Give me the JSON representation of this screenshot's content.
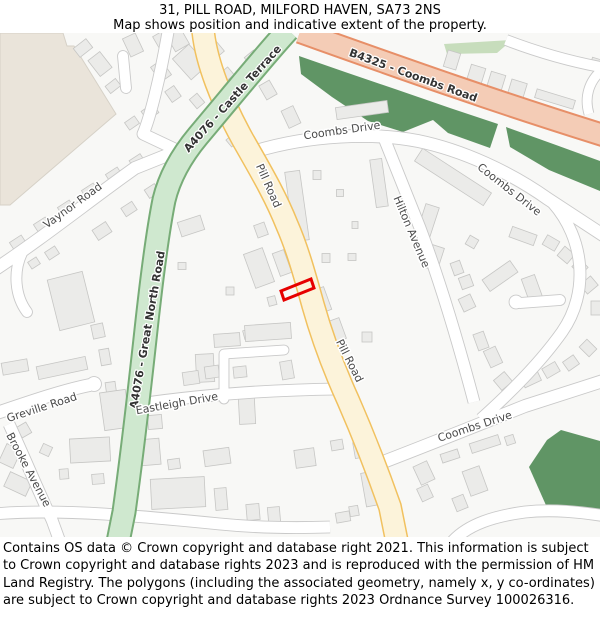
{
  "header": {
    "title": "31, PILL ROAD, MILFORD HAVEN, SA73 2NS",
    "subtitle": "Map shows position and indicative extent of the property."
  },
  "footer": {
    "text": "Contains OS data © Crown copyright and database right 2021. This information is subject to Crown copyright and database rights 2023 and is reproduced with the permission of HM Land Registry. The polygons (including the associated geometry, namely x, y co-ordinates) are subject to Crown copyright and database rights 2023 Ordnance Survey 100026316."
  },
  "map": {
    "background": "#f8f8f6",
    "colors": {
      "building_fill": "#ebebe9",
      "building_stroke": "#c6c6c4",
      "white_road_fill": "#ffffff",
      "white_road_casing": "#c9c9c9",
      "property_outline": "#e60000"
    },
    "areas": [
      {
        "name": "residential-beige-area",
        "fill": "#eae4da",
        "stroke": "#d6d1c7",
        "points": "0,33 63,33 67,46 74,46 116,114 10,205 0,205"
      },
      {
        "name": "grass-strip",
        "fill": "#c7ddbc",
        "stroke": "none",
        "points": "444,44 512,40 497,53 447,54"
      },
      {
        "name": "woodland-upper",
        "fill": "#609565",
        "stroke": "none",
        "points": "299,56 345,72 395,89 450,108 498,124 490,148 448,133 433,120 403,132 368,121 332,97 301,74"
      },
      {
        "name": "woodland-upper-right",
        "fill": "#609565",
        "stroke": "none",
        "points": "506,127 556,145 600,161 600,191 549,170 510,147"
      },
      {
        "name": "woodland-lower-right",
        "fill": "#609565",
        "stroke": "none",
        "points": "561,430 600,441 600,514 549,512 529,467 547,440"
      }
    ],
    "roads_white": [
      {
        "name": "vaynor-road",
        "d": "M -6 270 C 40 240 90 200 135 168 L 180 150",
        "w": 12
      },
      {
        "name": "vaynor-stub",
        "d": "M 22 253 C 13 272 15 296 27 312",
        "w": 10,
        "cap": "round"
      },
      {
        "name": "top-left-road",
        "d": "M 168 32 C 160 78 150 118 143 134 L 179 151",
        "w": 11
      },
      {
        "name": "top-left-stub",
        "d": "M 126 88 L 123 56",
        "w": 10,
        "cap": "round"
      },
      {
        "name": "coombs-drive-top",
        "d": "M 256 151 C 310 135 372 132 418 141 C 462 150 510 172 548 199 L 606 237",
        "w": 12
      },
      {
        "name": "hilton-avenue",
        "d": "M 384 138 L 420 228 C 435 268 455 330 474 402",
        "w": 11
      },
      {
        "name": "crescent-road",
        "d": "M 553 203 C 584 238 590 292 562 332 C 540 363 510 393 481 419",
        "w": 11
      },
      {
        "name": "crescent-spur",
        "d": "M 560 300 L 520 303",
        "w": 10,
        "cap": "round"
      },
      {
        "name": "greville-road",
        "d": "M -6 414 C 35 400 65 390 90 385",
        "w": 12
      },
      {
        "name": "brooke-avenue",
        "d": "M 9 424 C 22 452 38 490 52 520 L 60 542",
        "w": 11
      },
      {
        "name": "bottom-left-road",
        "d": "M -6 514 C 60 508 150 517 220 524 C 260 528 300 528 330 527",
        "w": 11
      },
      {
        "name": "eastleigh-drive",
        "d": "M 139 404 C 200 395 265 390 338 389",
        "w": 11
      },
      {
        "name": "service-road",
        "d": "M 224 399 L 224 354 L 284 350",
        "w": 9,
        "cap": "round"
      },
      {
        "name": "coombs-drive-bottom",
        "d": "M 378 464 C 430 444 480 424 525 406 L 606 380",
        "w": 12
      },
      {
        "name": "bottom-right-road",
        "d": "M 452 542 C 468 524 495 516 525 512 C 553 509 580 512 606 516",
        "w": 11
      },
      {
        "name": "top-right-road",
        "d": "M 506 40 C 540 53 572 62 606 68",
        "w": 10
      },
      {
        "name": "top-right-stub",
        "d": "M 602 70 C 589 81 584 97 589 114",
        "w": 9
      }
    ],
    "bulbs": [
      {
        "x": 94,
        "y": 384,
        "r": 7
      },
      {
        "x": 516,
        "y": 302,
        "r": 6.5
      }
    ],
    "roads_colored": [
      {
        "name": "pill-road",
        "fill": "#fcf3da",
        "casing": "#f1c15f",
        "w": 21,
        "cw": 24,
        "d": "M 203 30 C 206 62 222 102 243 140 C 266 180 277 200 287 225 C 298 250 306 280 313 305 C 322 337 333 367 348 400 C 362 432 377 470 390 507 L 397 542"
      },
      {
        "name": "b4325-coombs-road",
        "fill": "#f4ccb6",
        "casing": "#e78f68",
        "w": 20,
        "cw": 24,
        "d": "M 300 32 C 390 64 490 100 606 136"
      },
      {
        "name": "a4076-road",
        "fill": "#cfe8cf",
        "casing": "#77ac77",
        "w": 21,
        "cw": 25,
        "d": "M 288 30 C 265 55 235 92 198 136 C 183 154 170 175 164 200 C 158 230 152 275 146 330 C 140 385 132 455 124 512 L 118 542"
      }
    ],
    "buildings": [
      [
        83,
        48,
        16,
        11,
        -38
      ],
      [
        100,
        64,
        15,
        20,
        -38
      ],
      [
        113,
        86,
        13,
        9,
        -38
      ],
      [
        133,
        45,
        14,
        20,
        -25
      ],
      [
        162,
        40,
        13,
        15,
        -30
      ],
      [
        178,
        40,
        16,
        18,
        -30
      ],
      [
        161,
        71,
        13,
        18,
        -35
      ],
      [
        173,
        94,
        11,
        13,
        -35
      ],
      [
        150,
        112,
        14,
        11,
        -35
      ],
      [
        132,
        123,
        12,
        9,
        -35
      ],
      [
        190,
        62,
        22,
        28,
        -42
      ],
      [
        214,
        48,
        12,
        18,
        -40
      ],
      [
        227,
        74,
        10,
        10,
        -40
      ],
      [
        197,
        101,
        10,
        12,
        -40
      ],
      [
        207,
        121,
        13,
        17,
        -40
      ],
      [
        233,
        140,
        11,
        9,
        -40
      ],
      [
        254,
        60,
        12,
        16,
        -40
      ],
      [
        268,
        90,
        12,
        16,
        -30
      ],
      [
        291,
        117,
        13,
        19,
        -25
      ],
      [
        18,
        243,
        14,
        10,
        -33
      ],
      [
        42,
        225,
        14,
        10,
        -33
      ],
      [
        66,
        208,
        14,
        10,
        -33
      ],
      [
        90,
        191,
        14,
        10,
        -33
      ],
      [
        114,
        175,
        14,
        10,
        -33
      ],
      [
        137,
        161,
        13,
        9,
        -33
      ],
      [
        34,
        263,
        10,
        8,
        -33
      ],
      [
        52,
        253,
        12,
        9,
        -33
      ],
      [
        102,
        231,
        16,
        12,
        -33
      ],
      [
        129,
        209,
        13,
        10,
        -33
      ],
      [
        152,
        191,
        12,
        10,
        -33
      ],
      [
        170,
        174,
        11,
        9,
        -33
      ],
      [
        71,
        301,
        36,
        52,
        -14
      ],
      [
        98,
        331,
        12,
        14,
        -12
      ],
      [
        105,
        357,
        10,
        16,
        -10
      ],
      [
        111,
        389,
        10,
        14,
        -8
      ],
      [
        15,
        367,
        26,
        12,
        -10
      ],
      [
        62,
        368,
        50,
        13,
        -12
      ],
      [
        24,
        430,
        11,
        12,
        -30
      ],
      [
        10,
        456,
        16,
        20,
        25
      ],
      [
        18,
        484,
        24,
        16,
        25
      ],
      [
        46,
        450,
        10,
        10,
        25
      ],
      [
        191,
        226,
        24,
        15,
        -18
      ],
      [
        182,
        266,
        8,
        7,
        0
      ],
      [
        230,
        291,
        8,
        8,
        0
      ],
      [
        261,
        230,
        11,
        13,
        -20
      ],
      [
        259,
        268,
        20,
        36,
        -20
      ],
      [
        282,
        263,
        12,
        24,
        -20
      ],
      [
        272,
        301,
        8,
        9,
        -15
      ],
      [
        252,
        333,
        17,
        9,
        -15
      ],
      [
        268,
        332,
        46,
        16,
        -4
      ],
      [
        227,
        340,
        26,
        13,
        -4
      ],
      [
        205,
        368,
        18,
        28,
        -3
      ],
      [
        247,
        411,
        16,
        26,
        -3
      ],
      [
        191,
        378,
        16,
        13,
        -8
      ],
      [
        212,
        372,
        14,
        12,
        -8
      ],
      [
        240,
        372,
        13,
        11,
        -6
      ],
      [
        287,
        370,
        12,
        18,
        -10
      ],
      [
        297,
        206,
        15,
        70,
        -8
      ],
      [
        317,
        175,
        8,
        9,
        0
      ],
      [
        340,
        193,
        7,
        7,
        0
      ],
      [
        355,
        225,
        6,
        7,
        0
      ],
      [
        379,
        183,
        12,
        48,
        -8
      ],
      [
        326,
        258,
        8,
        9,
        0
      ],
      [
        352,
        257,
        8,
        7,
        0
      ],
      [
        322,
        300,
        12,
        24,
        -20
      ],
      [
        337,
        330,
        12,
        22,
        -20
      ],
      [
        325,
        348,
        14,
        20,
        -20
      ],
      [
        367,
        337,
        10,
        10,
        0
      ],
      [
        362,
        110,
        52,
        12,
        -8
      ],
      [
        452,
        60,
        13,
        17,
        17
      ],
      [
        476,
        75,
        15,
        18,
        17
      ],
      [
        496,
        82,
        15,
        18,
        17
      ],
      [
        517,
        90,
        16,
        18,
        17
      ],
      [
        555,
        99,
        40,
        9,
        17
      ],
      [
        596,
        63,
        10,
        9,
        17
      ],
      [
        453,
        177,
        82,
        15,
        33
      ],
      [
        428,
        220,
        14,
        30,
        18
      ],
      [
        435,
        258,
        12,
        24,
        18
      ],
      [
        472,
        242,
        10,
        10,
        30
      ],
      [
        523,
        236,
        26,
        11,
        20
      ],
      [
        551,
        243,
        14,
        11,
        30
      ],
      [
        566,
        255,
        13,
        12,
        40
      ],
      [
        580,
        267,
        12,
        11,
        45
      ],
      [
        589,
        285,
        12,
        14,
        50
      ],
      [
        500,
        276,
        34,
        14,
        -35
      ],
      [
        533,
        291,
        14,
        30,
        -20
      ],
      [
        457,
        268,
        10,
        13,
        -20
      ],
      [
        466,
        282,
        12,
        12,
        -20
      ],
      [
        467,
        303,
        13,
        14,
        -25
      ],
      [
        481,
        341,
        11,
        17,
        -20
      ],
      [
        493,
        357,
        13,
        18,
        -25
      ],
      [
        503,
        381,
        14,
        13,
        -40
      ],
      [
        531,
        379,
        18,
        11,
        -25
      ],
      [
        551,
        370,
        15,
        11,
        -30
      ],
      [
        571,
        363,
        13,
        11,
        -35
      ],
      [
        588,
        348,
        11,
        14,
        -45
      ],
      [
        596,
        308,
        10,
        14,
        0
      ],
      [
        90,
        450,
        40,
        24,
        -3
      ],
      [
        98,
        479,
        12,
        10,
        -5
      ],
      [
        64,
        474,
        9,
        10,
        -5
      ],
      [
        150,
        452,
        20,
        26,
        -5
      ],
      [
        174,
        464,
        12,
        10,
        -8
      ],
      [
        178,
        493,
        54,
        30,
        -3
      ],
      [
        217,
        457,
        26,
        16,
        -8
      ],
      [
        221,
        499,
        12,
        22,
        -5
      ],
      [
        253,
        512,
        13,
        16,
        -5
      ],
      [
        274,
        515,
        12,
        16,
        -5
      ],
      [
        305,
        458,
        20,
        18,
        -8
      ],
      [
        337,
        445,
        12,
        10,
        -10
      ],
      [
        358,
        450,
        8,
        16,
        -10
      ],
      [
        370,
        489,
        13,
        34,
        -10
      ],
      [
        354,
        511,
        9,
        10,
        -10
      ],
      [
        343,
        517,
        14,
        10,
        -10
      ],
      [
        424,
        473,
        15,
        20,
        -25
      ],
      [
        425,
        493,
        12,
        14,
        -25
      ],
      [
        475,
        481,
        18,
        26,
        -20
      ],
      [
        450,
        456,
        18,
        9,
        -18
      ],
      [
        485,
        444,
        30,
        10,
        -18
      ],
      [
        510,
        440,
        9,
        9,
        -18
      ],
      [
        460,
        503,
        12,
        14,
        -22
      ],
      [
        155,
        422,
        14,
        14,
        -5
      ],
      [
        115,
        410,
        26,
        38,
        -8
      ]
    ],
    "property": {
      "points": "281,291 311,279 314,288 284,300",
      "stroke": "#e60000"
    },
    "labels": [
      {
        "t": "A4076 - Castle Terrace",
        "x": 233,
        "y": 99,
        "r": -48,
        "c": "ref"
      },
      {
        "t": "A4076 - Great North Road",
        "x": 148,
        "y": 330,
        "r": -80,
        "c": "ref"
      },
      {
        "t": "B4325 - Coombs Road",
        "x": 413,
        "y": 76,
        "r": 20,
        "c": "ref"
      },
      {
        "t": "Pill Road",
        "x": 268,
        "y": 186,
        "r": 66,
        "c": "st"
      },
      {
        "t": "Pill Road",
        "x": 349,
        "y": 361,
        "r": 63,
        "c": "st"
      },
      {
        "t": "Coombs Drive",
        "x": 342,
        "y": 131,
        "r": -8,
        "c": "st"
      },
      {
        "t": "Coombs Drive",
        "x": 509,
        "y": 190,
        "r": 38,
        "c": "st"
      },
      {
        "t": "Hilton Avenue",
        "x": 411,
        "y": 232,
        "r": 67,
        "c": "st"
      },
      {
        "t": "Vaynor Road",
        "x": 73,
        "y": 206,
        "r": -36,
        "c": "st"
      },
      {
        "t": "Greville Road",
        "x": 42,
        "y": 408,
        "r": -18,
        "c": "st"
      },
      {
        "t": "Brooke Avenue",
        "x": 28,
        "y": 470,
        "r": 62,
        "c": "st"
      },
      {
        "t": "Eastleigh Drive",
        "x": 177,
        "y": 404,
        "r": -10,
        "c": "st"
      },
      {
        "t": "Coombs Drive",
        "x": 475,
        "y": 427,
        "r": -18,
        "c": "st"
      }
    ]
  }
}
